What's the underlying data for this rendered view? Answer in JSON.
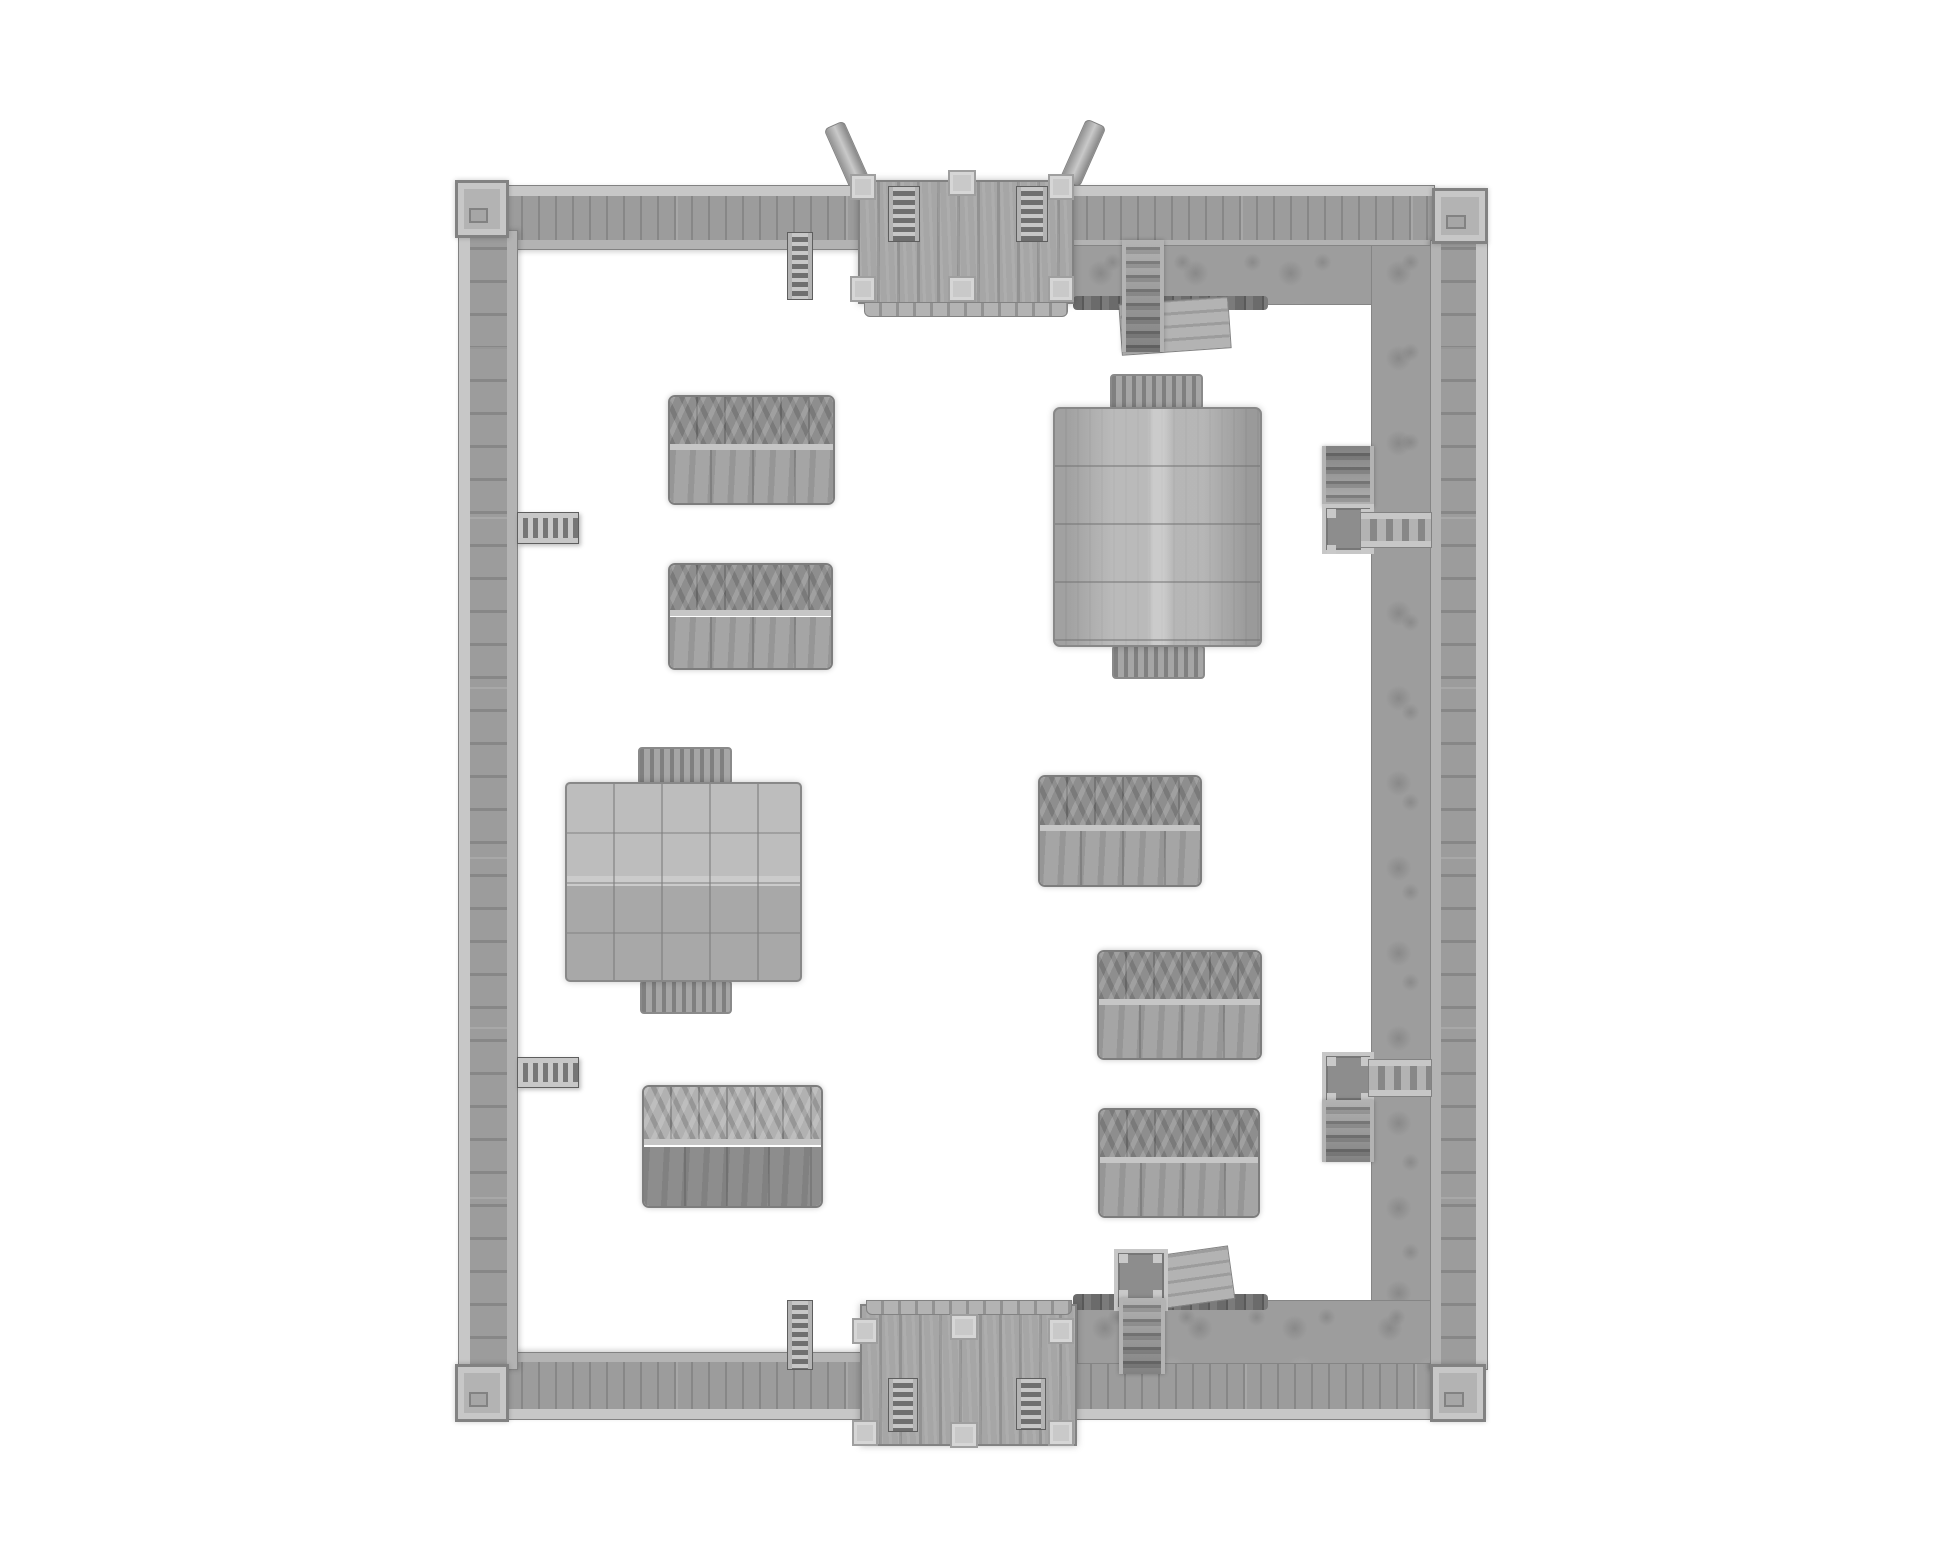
{
  "canvas": {
    "width": 1946,
    "height": 1557,
    "background": "#ffffff"
  },
  "palette": {
    "bg": "#ffffff",
    "wood": "#9c9c9c",
    "woodDark": "#878787",
    "woodLight": "#c7c7c7",
    "ledge": "#b3b3b3",
    "gate": "#a6a6a6",
    "gateDark": "#929292",
    "post": "#c9c9c9",
    "postEdge": "#9f9f9f",
    "dirt": "#9d9d9d",
    "dirtDark": "#858585",
    "stake": "#6b6b6b",
    "tentTop": "#8e8e8e",
    "tentBottom": "#a5a5a5",
    "ridge": "#c6c6c6",
    "canvasLight": "#b4b4b4",
    "outline": "#828282"
  },
  "scene": {
    "items": [
      {
        "name": "north-gate-beam-west",
        "kind": "beam",
        "x": 836,
        "y": 122,
        "w": 22,
        "h": 66,
        "rot": -24,
        "z": 1
      },
      {
        "name": "north-gate-beam-east",
        "kind": "beam",
        "x": 1072,
        "y": 120,
        "w": 22,
        "h": 66,
        "rot": 24,
        "z": 1
      },
      {
        "name": "north-wall-west-segment",
        "kind": "wall-top",
        "x": 505,
        "y": 185,
        "w": 358,
        "h": 65,
        "z": 2
      },
      {
        "name": "north-wall-east-segment",
        "kind": "wall-top",
        "x": 1070,
        "y": 185,
        "w": 365,
        "h": 65,
        "z": 2
      },
      {
        "name": "south-wall-west-segment",
        "kind": "wall-bottom",
        "x": 505,
        "y": 1352,
        "w": 358,
        "h": 68,
        "z": 2
      },
      {
        "name": "south-wall-east-segment",
        "kind": "wall-bottom",
        "x": 1074,
        "y": 1352,
        "w": 360,
        "h": 68,
        "z": 2
      },
      {
        "name": "west-wall",
        "kind": "wall-left",
        "x": 458,
        "y": 230,
        "w": 60,
        "h": 1140,
        "z": 2
      },
      {
        "name": "east-wall",
        "kind": "wall-right",
        "x": 1430,
        "y": 240,
        "w": 58,
        "h": 1130,
        "z": 2
      },
      {
        "name": "rampart-dirt-north",
        "kind": "dirt",
        "x": 1073,
        "y": 245,
        "w": 358,
        "h": 60,
        "z": 2
      },
      {
        "name": "rampart-dirt-east",
        "kind": "dirt",
        "x": 1371,
        "y": 245,
        "w": 60,
        "h": 1115,
        "z": 2
      },
      {
        "name": "rampart-dirt-south",
        "kind": "dirt",
        "x": 1077,
        "y": 1300,
        "w": 354,
        "h": 64,
        "z": 2
      },
      {
        "name": "palisade-stakes-north",
        "kind": "stakes",
        "x": 1073,
        "y": 296,
        "w": 195,
        "h": 14,
        "z": 3
      },
      {
        "name": "palisade-stakes-south",
        "kind": "stakes",
        "x": 1073,
        "y": 1294,
        "w": 195,
        "h": 16,
        "z": 3
      },
      {
        "name": "corner-tower-northwest",
        "kind": "tower",
        "x": 455,
        "y": 180,
        "w": 54,
        "h": 58,
        "z": 4
      },
      {
        "name": "corner-tower-northeast",
        "kind": "tower",
        "x": 1432,
        "y": 188,
        "w": 56,
        "h": 56,
        "z": 4
      },
      {
        "name": "corner-tower-southwest",
        "kind": "tower",
        "x": 455,
        "y": 1364,
        "w": 54,
        "h": 58,
        "z": 4
      },
      {
        "name": "corner-tower-southeast",
        "kind": "tower",
        "x": 1430,
        "y": 1364,
        "w": 56,
        "h": 58,
        "z": 4
      },
      {
        "name": "north-gatehouse-roof",
        "kind": "gate-roof",
        "x": 858,
        "y": 180,
        "w": 216,
        "h": 124,
        "z": 3
      },
      {
        "name": "north-gatehouse-fringe",
        "kind": "fringe",
        "x": 864,
        "y": 302,
        "w": 204,
        "h": 15,
        "z": 3
      },
      {
        "name": "north-gate-post-nw",
        "kind": "post",
        "x": 850,
        "y": 174,
        "w": 26,
        "h": 26,
        "z": 5
      },
      {
        "name": "north-gate-post-n",
        "kind": "post",
        "x": 948,
        "y": 170,
        "w": 28,
        "h": 26,
        "z": 5
      },
      {
        "name": "north-gate-post-ne",
        "kind": "post",
        "x": 1048,
        "y": 174,
        "w": 26,
        "h": 26,
        "z": 5
      },
      {
        "name": "north-gate-post-sw",
        "kind": "post",
        "x": 850,
        "y": 276,
        "w": 26,
        "h": 26,
        "z": 5
      },
      {
        "name": "north-gate-post-s",
        "kind": "post",
        "x": 948,
        "y": 276,
        "w": 28,
        "h": 26,
        "z": 5
      },
      {
        "name": "north-gate-post-se",
        "kind": "post",
        "x": 1048,
        "y": 276,
        "w": 26,
        "h": 26,
        "z": 5
      },
      {
        "name": "north-gate-ladder-west",
        "kind": "ladder-v",
        "x": 888,
        "y": 186,
        "w": 32,
        "h": 56,
        "z": 4
      },
      {
        "name": "north-gate-ladder-east",
        "kind": "ladder-v",
        "x": 1016,
        "y": 186,
        "w": 32,
        "h": 56,
        "z": 4
      },
      {
        "name": "south-gatehouse-roof",
        "kind": "gate-roof",
        "x": 860,
        "y": 1304,
        "w": 217,
        "h": 142,
        "z": 3
      },
      {
        "name": "south-gatehouse-fringe",
        "kind": "fringe",
        "x": 866,
        "y": 1300,
        "w": 206,
        "h": 15,
        "z": 4
      },
      {
        "name": "south-gate-post-nw",
        "kind": "post",
        "x": 852,
        "y": 1318,
        "w": 26,
        "h": 26,
        "z": 5
      },
      {
        "name": "south-gate-post-n",
        "kind": "post",
        "x": 950,
        "y": 1314,
        "w": 28,
        "h": 26,
        "z": 5
      },
      {
        "name": "south-gate-post-ne",
        "kind": "post",
        "x": 1048,
        "y": 1318,
        "w": 26,
        "h": 26,
        "z": 5
      },
      {
        "name": "south-gate-post-sw",
        "kind": "post",
        "x": 852,
        "y": 1420,
        "w": 26,
        "h": 26,
        "z": 5
      },
      {
        "name": "south-gate-post-s",
        "kind": "post",
        "x": 950,
        "y": 1422,
        "w": 28,
        "h": 26,
        "z": 5
      },
      {
        "name": "south-gate-post-se",
        "kind": "post",
        "x": 1048,
        "y": 1420,
        "w": 26,
        "h": 26,
        "z": 5
      },
      {
        "name": "south-gate-ladder-west",
        "kind": "ladder-v",
        "x": 888,
        "y": 1378,
        "w": 30,
        "h": 54,
        "z": 4
      },
      {
        "name": "south-gate-ladder-east",
        "kind": "ladder-v",
        "x": 1016,
        "y": 1378,
        "w": 30,
        "h": 52,
        "z": 4
      },
      {
        "name": "north-wall-ladder",
        "kind": "ladder-v",
        "x": 787,
        "y": 232,
        "w": 26,
        "h": 68,
        "z": 4
      },
      {
        "name": "south-wall-ladder",
        "kind": "ladder-v",
        "x": 787,
        "y": 1300,
        "w": 26,
        "h": 70,
        "z": 4
      },
      {
        "name": "west-wall-stair-upper",
        "kind": "ladder-h",
        "x": 517,
        "y": 512,
        "w": 62,
        "h": 32,
        "z": 4
      },
      {
        "name": "west-wall-stair-lower",
        "kind": "ladder-h",
        "x": 517,
        "y": 1057,
        "w": 62,
        "h": 31,
        "z": 4
      },
      {
        "name": "north-rampart-stair",
        "kind": "stair-v",
        "x": 1122,
        "y": 240,
        "w": 42,
        "h": 112,
        "z": 4
      },
      {
        "name": "north-rampart-ramp",
        "kind": "ramp",
        "x": 1120,
        "y": 300,
        "w": 110,
        "h": 52,
        "rot": -4,
        "z": 3
      },
      {
        "name": "east-stair-upper-steps",
        "kind": "stair-v-up",
        "x": 1322,
        "y": 446,
        "w": 52,
        "h": 62,
        "z": 4
      },
      {
        "name": "east-stair-upper-landing",
        "kind": "landing",
        "x": 1322,
        "y": 504,
        "w": 52,
        "h": 50,
        "z": 4
      },
      {
        "name": "east-stair-upper-bridge",
        "kind": "bridge",
        "x": 1360,
        "y": 512,
        "w": 72,
        "h": 36,
        "z": 5
      },
      {
        "name": "east-stair-lower-landing",
        "kind": "landing",
        "x": 1322,
        "y": 1052,
        "w": 52,
        "h": 52,
        "z": 4
      },
      {
        "name": "east-stair-lower-bridge",
        "kind": "bridge",
        "x": 1368,
        "y": 1059,
        "w": 64,
        "h": 38,
        "z": 5
      },
      {
        "name": "east-stair-lower-steps",
        "kind": "stair-v",
        "x": 1322,
        "y": 1100,
        "w": 52,
        "h": 62,
        "z": 4
      },
      {
        "name": "south-rampart-landing",
        "kind": "landing",
        "x": 1114,
        "y": 1249,
        "w": 54,
        "h": 62,
        "z": 4
      },
      {
        "name": "south-rampart-stair",
        "kind": "stair-v",
        "x": 1119,
        "y": 1298,
        "w": 46,
        "h": 76,
        "z": 4
      },
      {
        "name": "south-rampart-ramp",
        "kind": "ramp",
        "x": 1162,
        "y": 1250,
        "w": 70,
        "h": 54,
        "rot": -8,
        "z": 3
      },
      {
        "name": "tent-northwest-1",
        "kind": "tent",
        "x": 668,
        "y": 395,
        "w": 167,
        "h": 110,
        "z": 3
      },
      {
        "name": "tent-northwest-2",
        "kind": "tent",
        "x": 668,
        "y": 563,
        "w": 165,
        "h": 107,
        "z": 3
      },
      {
        "name": "tent-southwest",
        "kind": "tent-rev",
        "x": 642,
        "y": 1085,
        "w": 181,
        "h": 123,
        "z": 3
      },
      {
        "name": "tent-east-middle",
        "kind": "tent",
        "x": 1038,
        "y": 775,
        "w": 164,
        "h": 112,
        "z": 3
      },
      {
        "name": "tent-east-lower-1",
        "kind": "tent",
        "x": 1097,
        "y": 950,
        "w": 165,
        "h": 110,
        "z": 3
      },
      {
        "name": "tent-east-lower-2",
        "kind": "tent",
        "x": 1098,
        "y": 1108,
        "w": 162,
        "h": 110,
        "z": 3
      },
      {
        "name": "marquee-flap-north",
        "kind": "flap",
        "x": 638,
        "y": 747,
        "w": 94,
        "h": 38,
        "z": 3
      },
      {
        "name": "marquee-flap-south",
        "kind": "flap",
        "x": 640,
        "y": 980,
        "w": 92,
        "h": 34,
        "z": 3
      },
      {
        "name": "marquee-tent-west",
        "kind": "marquee",
        "x": 565,
        "y": 782,
        "w": 237,
        "h": 200,
        "z": 4
      },
      {
        "name": "pavilion-flap-north",
        "kind": "flap",
        "x": 1110,
        "y": 374,
        "w": 93,
        "h": 36,
        "z": 3
      },
      {
        "name": "pavilion-flap-south",
        "kind": "flap",
        "x": 1112,
        "y": 645,
        "w": 93,
        "h": 34,
        "z": 3
      },
      {
        "name": "pavilion-tent-east",
        "kind": "pavilion",
        "x": 1053,
        "y": 407,
        "w": 209,
        "h": 240,
        "z": 4
      }
    ]
  }
}
